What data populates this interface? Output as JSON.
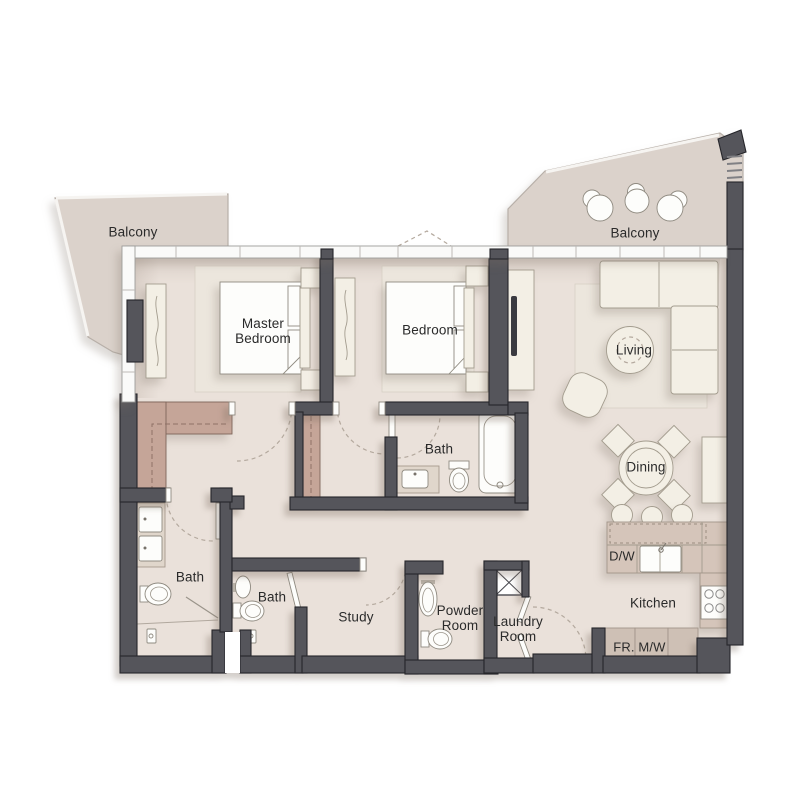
{
  "plan": {
    "type": "apartment-floor-plan",
    "labels": {
      "balcony_left": "Balcony",
      "balcony_right": "Balcony",
      "master_line1": "Master",
      "master_line2": "Bedroom",
      "bedroom": "Bedroom",
      "living": "Living",
      "dining": "Dining",
      "bath_upper": "Bath",
      "bath_left": "Bath",
      "bath_mid": "Bath",
      "study": "Study",
      "powder_line1": "Powder",
      "powder_line2": "Room",
      "laundry_line1": "Laundry",
      "laundry_line2": "Room",
      "kitchen": "Kitchen",
      "dishwasher": "D/W",
      "fridge": "FR.",
      "microwave": "M/W"
    },
    "rooms": [
      "Balcony",
      "Master Bedroom",
      "Bedroom",
      "Living",
      "Dining",
      "Kitchen",
      "Bath",
      "Bath",
      "Bath",
      "Study",
      "Powder Room",
      "Laundry Room",
      "Balcony"
    ],
    "fixtures": [
      "double-bed",
      "wardrobe",
      "walk-in-closet",
      "l-shaped-sofa",
      "coffee-table",
      "armchair",
      "tv",
      "dining-table",
      "dining-chair",
      "bar-stool",
      "kitchen-island",
      "kitchen-sink",
      "dishwasher",
      "cooktop",
      "fridge-counter",
      "microwave-counter",
      "bathtub",
      "toilet",
      "sink",
      "double-vanity",
      "shower",
      "washing-machine",
      "balcony-chair"
    ],
    "colors": {
      "floor": "#eae1da",
      "balcony_floor": "#dbd2cb",
      "wall": "#55555b",
      "closet": "#c5a598",
      "counter": "#d5c5ba",
      "counter_dark": "#cec0b5",
      "furniture": "#f3efe5",
      "fixture_white": "#fdfdfb",
      "vanity": "#e0d6cb",
      "rug": "#ece6dd",
      "label_text": "#2a2a2a"
    }
  }
}
